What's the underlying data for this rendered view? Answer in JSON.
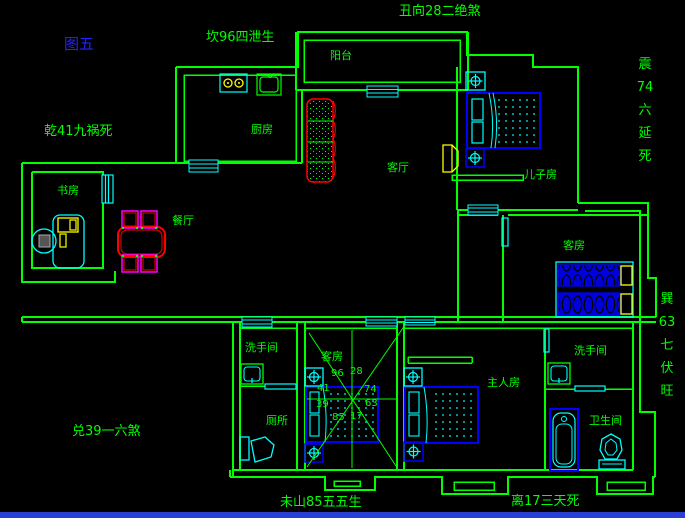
{
  "figure": {
    "label": "图五"
  },
  "annotations": {
    "kan": "坎96四泄生",
    "chou": "丑向28二绝煞",
    "qian": "乾41九祸死",
    "zhen": [
      "震",
      "74",
      "六",
      "延",
      "死"
    ],
    "xun": [
      "巽",
      "63",
      "七",
      "伏",
      "旺"
    ],
    "dui": "兑39一六煞",
    "weishan": "未山85五五生",
    "li": "离17三天死"
  },
  "rooms": {
    "balcony": "阳台",
    "kitchen": "厨房",
    "living_room": "客厅",
    "son_room": "儿子房",
    "study": "书房",
    "dining_room": "餐厅",
    "guest_room_east": "客房",
    "guest_room_south": "客房",
    "washroom_west": "洗手间",
    "toilet": "厕所",
    "master_room": "主人房",
    "washroom_east": "洗手间",
    "bathroom": "卫生间"
  },
  "compass": {
    "numbers": [
      "96",
      "28",
      "41",
      "74",
      "39",
      "63",
      "85",
      "17"
    ]
  },
  "colors": {
    "wall": "#00ff00",
    "fixture": "#00ffff",
    "bed": "#0000ff",
    "accent": "#ffff00",
    "sofa": "#ff0000",
    "chair": "#ff00ff",
    "text": "#00ff00",
    "figure_label": "#2222ff",
    "window_strip": "#2a3fd4"
  }
}
